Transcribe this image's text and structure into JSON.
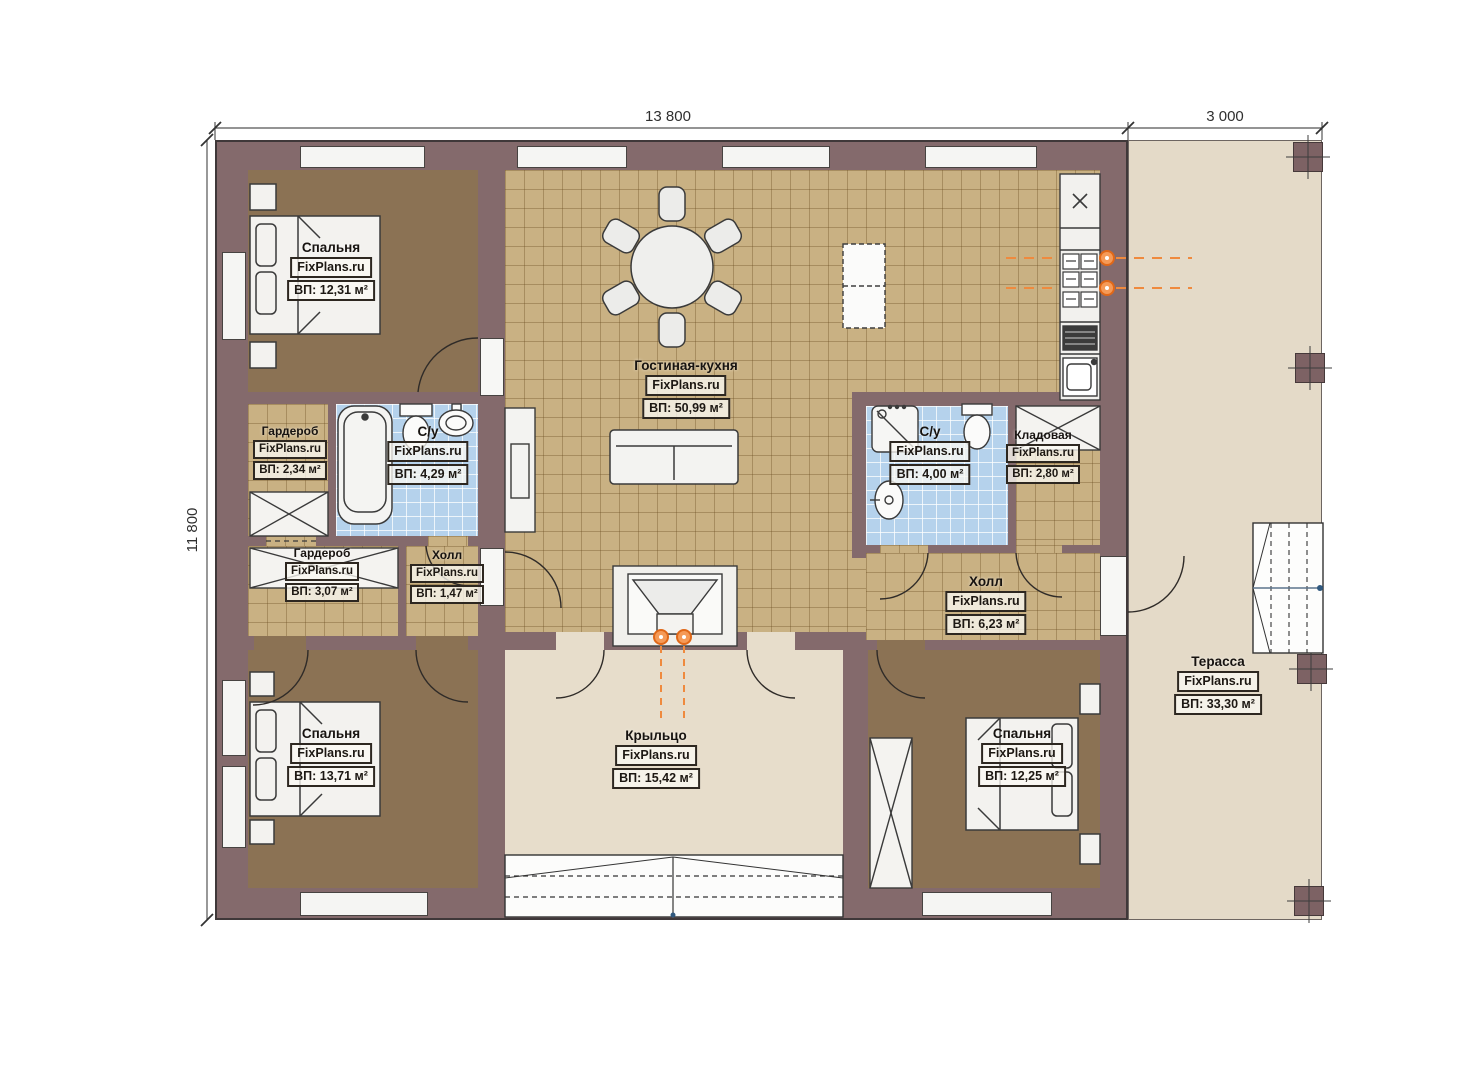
{
  "plan_title": "Одноэтажный дом — план этажа",
  "watermark": "FixPlans.ru",
  "dimensions": {
    "top_main": "13 800",
    "top_terrace": "3 000",
    "left_side": "11 800"
  },
  "rooms": [
    {
      "id": "bedroom-top-left",
      "name": "Спальня",
      "watermark": "FixPlans.ru",
      "area": "ВП: 12,31 м²"
    },
    {
      "id": "wardrobe-top",
      "name": "Гардероб",
      "watermark": "FixPlans.ru",
      "area": "ВП: 2,34 м²"
    },
    {
      "id": "bathroom-left",
      "name": "С/у",
      "watermark": "FixPlans.ru",
      "area": "ВП: 4,29 м²"
    },
    {
      "id": "wardrobe-bottom",
      "name": "Гардероб",
      "watermark": "FixPlans.ru",
      "area": "ВП: 3,07 м²"
    },
    {
      "id": "hall-small",
      "name": "Холл",
      "watermark": "FixPlans.ru",
      "area": "ВП: 1,47 м²"
    },
    {
      "id": "bedroom-bottom-left",
      "name": "Спальня",
      "watermark": "FixPlans.ru",
      "area": "ВП: 13,71 м²"
    },
    {
      "id": "living-kitchen",
      "name": "Гостиная-кухня",
      "watermark": "FixPlans.ru",
      "area": "ВП: 50,99 м²"
    },
    {
      "id": "bathroom-right",
      "name": "С/у",
      "watermark": "FixPlans.ru",
      "area": "ВП: 4,00 м²"
    },
    {
      "id": "storage",
      "name": "Кладовая",
      "watermark": "FixPlans.ru",
      "area": "ВП: 2,80 м²"
    },
    {
      "id": "hall-right",
      "name": "Холл",
      "watermark": "FixPlans.ru",
      "area": "ВП: 6,23 м²"
    },
    {
      "id": "bedroom-bottom-right",
      "name": "Спальня",
      "watermark": "FixPlans.ru",
      "area": "ВП: 12,25 м²"
    },
    {
      "id": "porch",
      "name": "Крыльцо",
      "watermark": "FixPlans.ru",
      "area": "ВП: 15,42 м²"
    },
    {
      "id": "terrace",
      "name": "Терасса",
      "watermark": "FixPlans.ru",
      "area": "ВП: 33,30 м²"
    }
  ],
  "colors": {
    "wall": "#846a6c",
    "bedroom_floor": "#8b7254",
    "tile_floor": "#c9b183",
    "bathroom_tile": "#b5d2ec",
    "porch_floor": "#e7ddcb",
    "terrace_floor": "#e4dac8",
    "accent_orange": "#ef8236",
    "dimension_text": "#2f2f2f"
  }
}
